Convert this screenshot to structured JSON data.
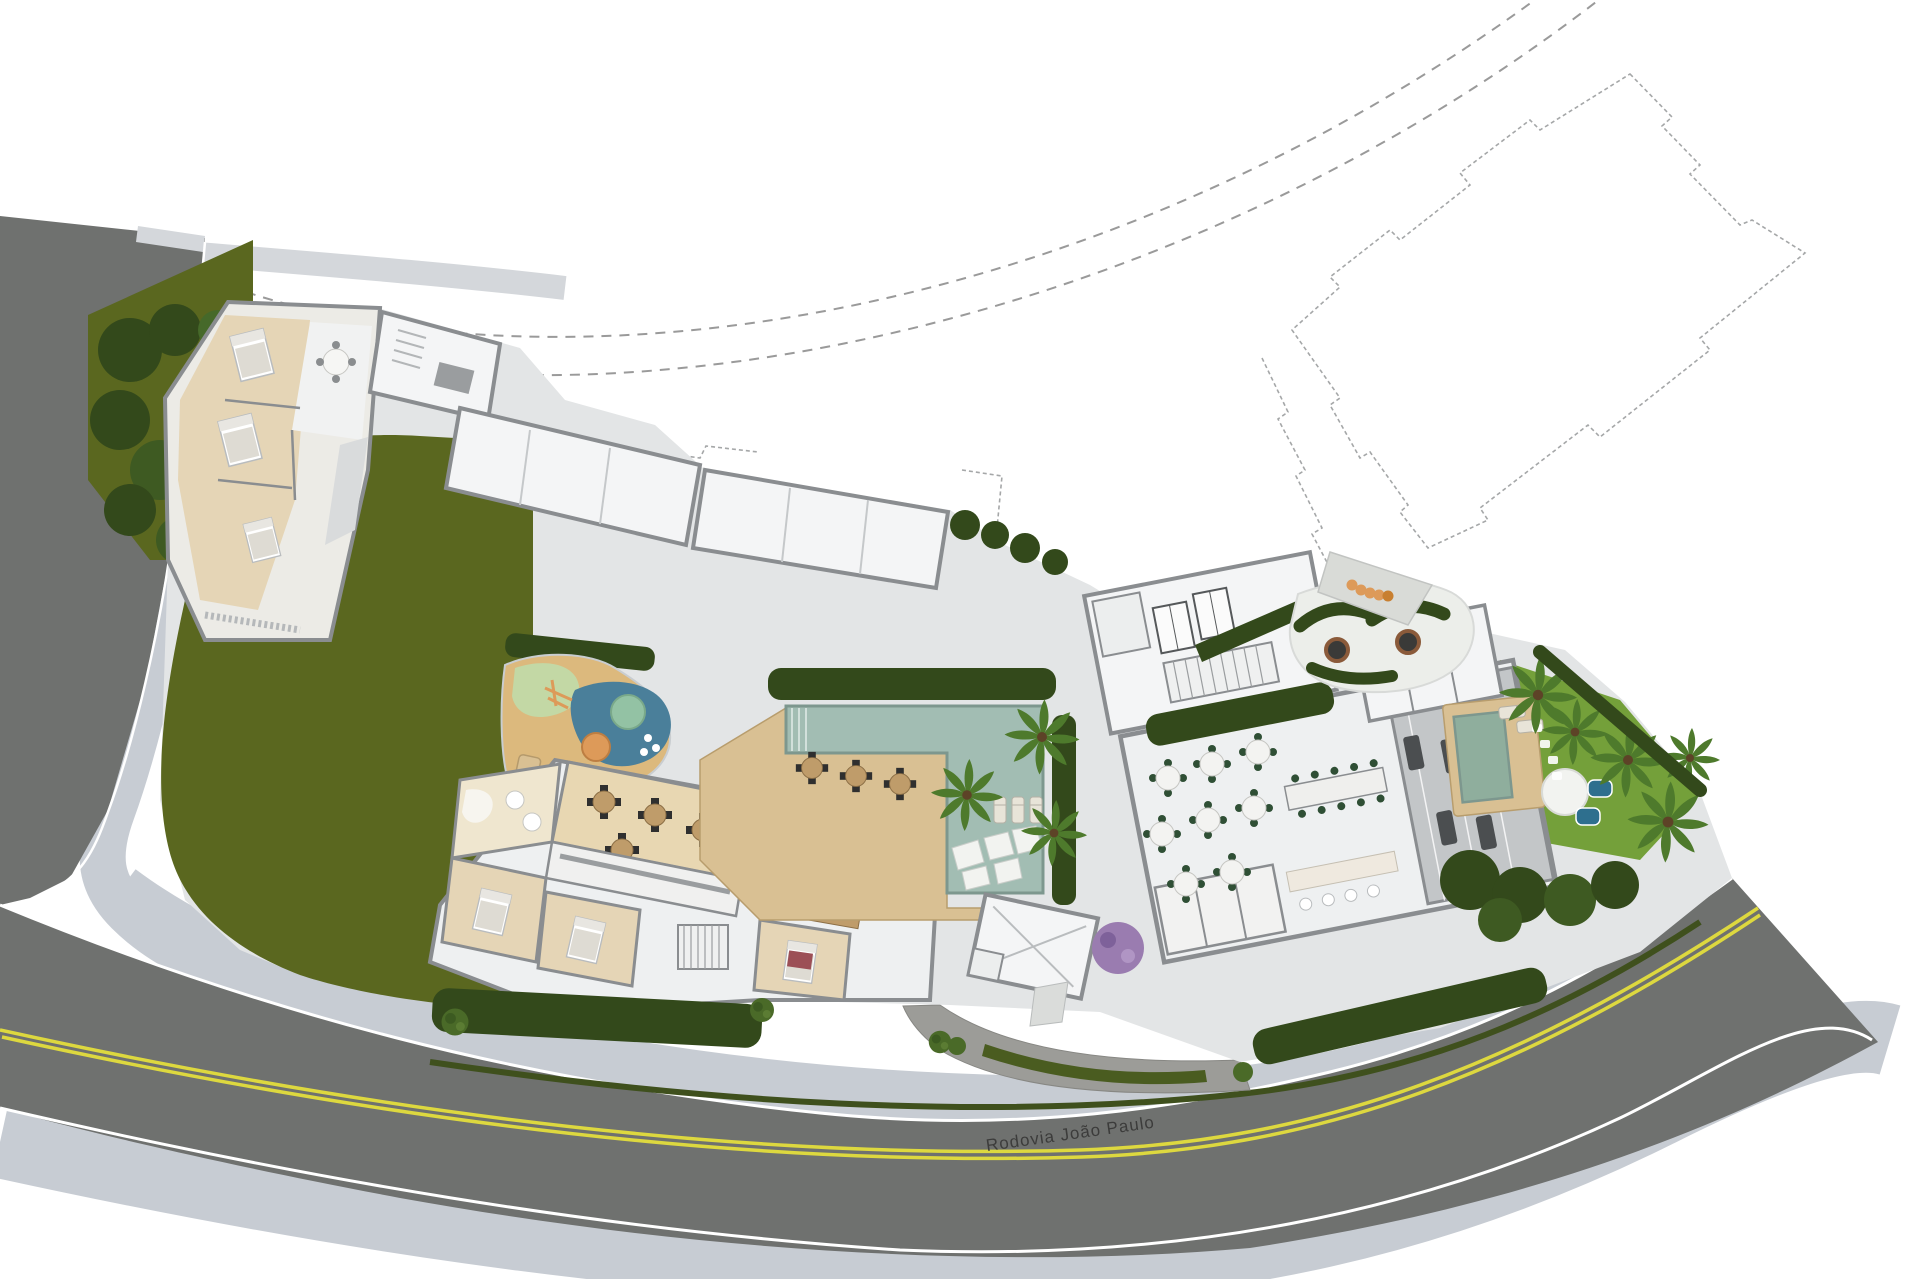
{
  "meta": {
    "title": "Residential development implantation site plan (aerial rendering)",
    "view": "top-down architectural masterplan"
  },
  "scene": {
    "road_label": "Rodovia João Paulo",
    "features": [
      "perimeter-street",
      "highway-with-double-yellow-line",
      "sidewalks",
      "entrance-driveway",
      "guard-house",
      "large-lawn",
      "hedges",
      "block-a-apartments",
      "white-roof-annex",
      "amenities-building",
      "party-room",
      "kids-room",
      "kitchen",
      "suites",
      "elevator-cores",
      "gourmet-hall",
      "long-dining-table",
      "gym",
      "parking-stalls",
      "spa-deck",
      "plunge-pools",
      "zen-space",
      "swimming-pool",
      "wood-deck",
      "pool-bridge",
      "pool-loungers",
      "playground",
      "fire-pits",
      "pet-place",
      "palm-trees",
      "tower-footprint-dashed-outline",
      "street-boundary-dashed-lines"
    ]
  },
  "palette": {
    "bg": "#ffffff",
    "asphalt": "#6f716f",
    "cobble": "#9c9c98",
    "sidewalk": "#c7ccd3",
    "sidewalk_bright": "#d4d7db",
    "curb": "#ffffff",
    "lane_yellow": "#ddd83f",
    "lawn_olive": "#5a671f",
    "lawn_bright": "#74a03a",
    "hedge_dark": "#33491b",
    "shrub": "#4a6a28",
    "palm": "#4e7a2c",
    "slab": "#e3e5e6",
    "wall": "#8a8d90",
    "roof_white": "#f4f5f6",
    "room_white": "#eef0f1",
    "wood_deck": "#d9c093",
    "wood_floor": "#e8d7b2",
    "room_beige": "#e5d5b6",
    "table_wood": "#bf9c6a",
    "pool_teal": "#a2bdb3",
    "pool_edge": "#7d978e",
    "spa_blue": "#2e6f8e",
    "kids_blue": "#4a7f9a",
    "sand": "#dcb97d",
    "mint": "#c3d8a5",
    "play_orange": "#dd9a59",
    "play_teal": "#93c2a4",
    "median_green": "#4a5c20",
    "purple_tree": "#9a7cb0",
    "gym_floor": "#c3c6c8",
    "equipment": "#4b4e50",
    "chair_green": "#2f4f35",
    "chair_black": "#2f2f2f",
    "stone_white": "#f2f3f0",
    "fire_ring": "#8a5a3a",
    "text_dark": "#3c3c3b",
    "dash_gray": "#9a9a9a",
    "outline_gray": "#a5a7a8",
    "gravel": "#eceeea"
  }
}
